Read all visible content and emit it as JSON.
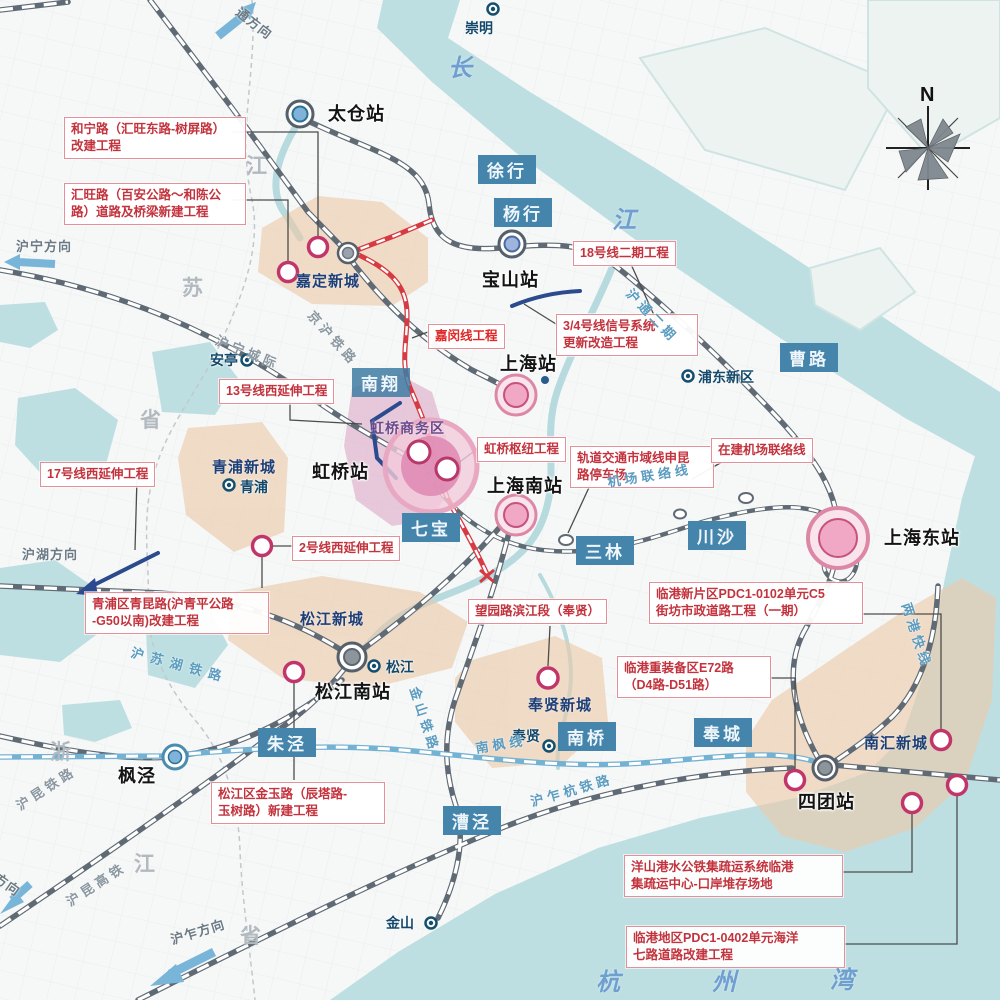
{
  "compass": {
    "north_label": "N"
  },
  "projects": [
    {
      "label": "和宁路（汇旺东路-树屏路）\n改建工程"
    },
    {
      "label": "汇旺路（百安公路～和陈公\n路）道路及桥梁新建工程"
    },
    {
      "label": "18号线二期工程"
    },
    {
      "label": "嘉闵线工程"
    },
    {
      "label": "3/4号线信号系统\n更新改造工程"
    },
    {
      "label": "13号线西延伸工程"
    },
    {
      "label": "虹桥枢纽工程"
    },
    {
      "label": "轨道交通市域线申昆\n路停车场"
    },
    {
      "label": "在建机场联络线"
    },
    {
      "label": "17号线西延伸工程"
    },
    {
      "label": "2号线西延伸工程"
    },
    {
      "label": "青浦区青昆路(沪青平公路\n-G50以南)改建工程"
    },
    {
      "label": "望园路滨江段（奉贤）"
    },
    {
      "label": "临港新片区PDC1-0102单元C5\n街坊市政道路工程（一期）"
    },
    {
      "label": "临港重装备区E72路\n（D4路-D51路）"
    },
    {
      "label": "松江区金玉路（辰塔路-\n玉树路）新建工程"
    },
    {
      "label": "洋山港水公铁集疏运系统临港\n集疏运中心-口岸堆存场地"
    },
    {
      "label": "临港地区PDC1-0402单元海洋\n七路道路改建工程"
    }
  ],
  "towns": [
    {
      "label": "徐行"
    },
    {
      "label": "杨行"
    },
    {
      "label": "曹路"
    },
    {
      "label": "南翔"
    },
    {
      "label": "七宝"
    },
    {
      "label": "三林"
    },
    {
      "label": "川沙"
    },
    {
      "label": "朱泾"
    },
    {
      "label": "南桥"
    },
    {
      "label": "奉城"
    },
    {
      "label": "漕泾"
    }
  ],
  "stations": [
    {
      "label": "太仓站"
    },
    {
      "label": "宝山站"
    },
    {
      "label": "上海站"
    },
    {
      "label": "虹桥站"
    },
    {
      "label": "上海南站"
    },
    {
      "label": "上海东站"
    },
    {
      "label": "松江南站"
    },
    {
      "label": "四团站"
    },
    {
      "label": "枫泾"
    }
  ],
  "places": [
    {
      "label": "崇明"
    },
    {
      "label": "安亭"
    },
    {
      "label": "青浦"
    },
    {
      "label": "松江"
    },
    {
      "label": "奉贤"
    },
    {
      "label": "金山"
    },
    {
      "label": "浦东新区"
    }
  ],
  "new_towns": [
    {
      "label": "嘉定新城"
    },
    {
      "label": "青浦新城"
    },
    {
      "label": "松江新城"
    },
    {
      "label": "奉贤新城"
    },
    {
      "label": "南汇新城"
    },
    {
      "label": "虹桥商务区"
    }
  ],
  "railway_labels": [
    {
      "label": "京沪铁路"
    },
    {
      "label": "沪宁城际"
    },
    {
      "label": "沪通二期"
    },
    {
      "label": "机场联络线"
    },
    {
      "label": "沪苏湖铁路"
    },
    {
      "label": "金山铁路"
    },
    {
      "label": "南枫线"
    },
    {
      "label": "沪乍杭铁路"
    },
    {
      "label": "沪昆铁路"
    },
    {
      "label": "沪昆高铁"
    },
    {
      "label": "两港快线"
    }
  ],
  "direction_labels": [
    {
      "label": "通方向"
    },
    {
      "label": "沪宁方向"
    },
    {
      "label": "沪湖方向"
    },
    {
      "label": "方向"
    },
    {
      "label": "沪乍方向"
    }
  ],
  "water_labels": [
    {
      "ch": "长"
    },
    {
      "ch": "江"
    },
    {
      "ch": "杭"
    },
    {
      "ch": "州"
    },
    {
      "ch": "湾"
    }
  ],
  "province_labels": [
    {
      "ch": "江"
    },
    {
      "ch": "苏"
    },
    {
      "ch": "省"
    },
    {
      "ch": "浙"
    },
    {
      "ch": "江"
    },
    {
      "ch": "省"
    }
  ],
  "colors": {
    "water": "#bedfe2",
    "new_town_fill": "#ebc9a9",
    "hongqiao_fill": "#dca9c6",
    "rail_gray": "#5f6a74",
    "rail_red": "#d63a42",
    "rail_navy": "#2c4a8e",
    "town_box": "#4584ab",
    "project_text": "#c3333d",
    "marker_ring": "#c2356a",
    "arrow_blue": "#79b5d8"
  }
}
